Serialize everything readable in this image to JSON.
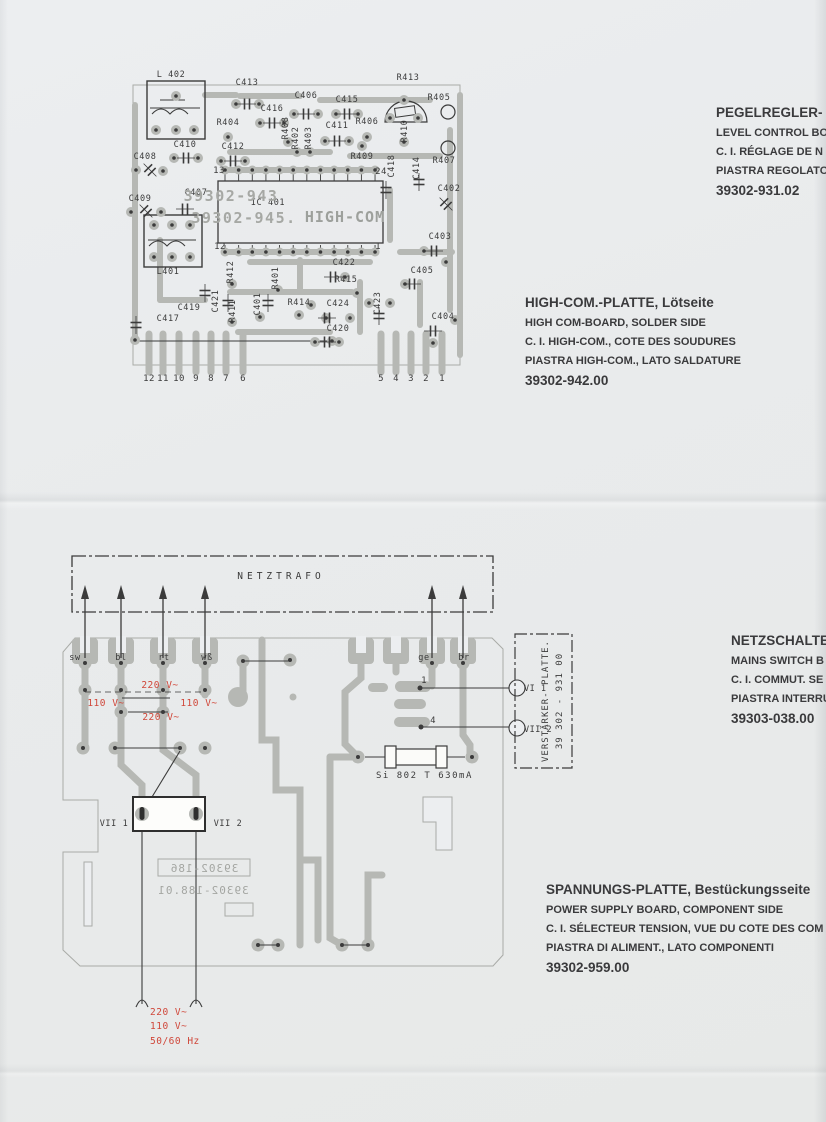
{
  "colors": {
    "trace": "#b6b8b4",
    "ink": "#3b3b3b",
    "faded_print": "#a6a8a4",
    "red": "#d0473a",
    "paper": "#e9ebec"
  },
  "captions": {
    "level_control": {
      "lines": [
        "PEGELREGLER-",
        "LEVEL CONTROL BO",
        "C. I. RÉGLAGE DE N",
        "PIASTRA REGOLATO",
        "39302-931.02"
      ]
    },
    "highcom": {
      "lines": [
        "HIGH-COM.-PLATTE, Lötseite",
        "HIGH COM-BOARD, SOLDER SIDE",
        "C. I. HIGH-COM., COTE DES SOUDURES",
        "PIASTRA HIGH-COM., LATO SALDATURE",
        "39302-942.00"
      ]
    },
    "mains_switch": {
      "lines": [
        "NETZSCHALTE",
        "MAINS SWITCH B",
        "C. I. COMMUT. SE",
        "PIASTRA INTERRU",
        "39303-038.00"
      ]
    },
    "power_supply": {
      "lines": [
        "SPANNUNGS-PLATTE, Bestückungsseite",
        "POWER SUPPLY BOARD, COMPONENT SIDE",
        "C. I. SÉLECTEUR TENSION, VUE DU COTE DES COM",
        "PIASTRA DI ALIMENT., LATO COMPONENTI",
        "39302-959.00"
      ]
    }
  },
  "top_board": {
    "labels": [
      {
        "t": "L 402",
        "x": 171,
        "y": 77
      },
      {
        "t": "C413",
        "x": 247,
        "y": 85
      },
      {
        "t": "C406",
        "x": 306,
        "y": 98
      },
      {
        "t": "C415",
        "x": 347,
        "y": 102
      },
      {
        "t": "R413",
        "x": 408,
        "y": 80
      },
      {
        "t": "R405",
        "x": 439,
        "y": 100
      },
      {
        "t": "R404",
        "x": 228,
        "y": 125
      },
      {
        "t": "C416",
        "x": 272,
        "y": 111
      },
      {
        "t": "C411",
        "x": 337,
        "y": 128
      },
      {
        "t": "R406",
        "x": 367,
        "y": 124
      },
      {
        "t": "C412",
        "x": 233,
        "y": 149
      },
      {
        "t": "C410",
        "x": 185,
        "y": 147
      },
      {
        "t": "C408",
        "x": 145,
        "y": 159
      },
      {
        "t": "C409",
        "x": 140,
        "y": 201
      },
      {
        "t": "C407",
        "x": 196,
        "y": 195
      },
      {
        "t": "R409",
        "x": 362,
        "y": 159
      },
      {
        "t": "R407",
        "x": 444,
        "y": 163
      },
      {
        "t": "C402",
        "x": 449,
        "y": 191
      },
      {
        "t": "C403",
        "x": 440,
        "y": 239
      },
      {
        "t": "C405",
        "x": 422,
        "y": 273
      },
      {
        "t": "C404",
        "x": 443,
        "y": 319
      },
      {
        "t": "C422",
        "x": 344,
        "y": 265
      },
      {
        "t": "R415",
        "x": 346,
        "y": 282
      },
      {
        "t": "R414",
        "x": 299,
        "y": 305
      },
      {
        "t": "C424",
        "x": 338,
        "y": 306
      },
      {
        "t": "C420",
        "x": 338,
        "y": 331
      },
      {
        "t": "C419",
        "x": 189,
        "y": 310
      },
      {
        "t": "C417",
        "x": 168,
        "y": 321
      },
      {
        "t": "L401",
        "x": 168,
        "y": 274
      },
      {
        "t": "IC 401",
        "x": 268,
        "y": 205
      },
      {
        "t": "R408",
        "x": 288,
        "y": 128,
        "r": -90
      },
      {
        "t": "R402",
        "x": 298,
        "y": 138,
        "r": -90
      },
      {
        "t": "R403",
        "x": 311,
        "y": 138,
        "r": -90
      },
      {
        "t": "R410",
        "x": 407,
        "y": 131,
        "r": -90
      },
      {
        "t": "C418",
        "x": 394,
        "y": 166,
        "r": -90
      },
      {
        "t": "C414",
        "x": 419,
        "y": 168,
        "r": -90
      },
      {
        "t": "R412",
        "x": 233,
        "y": 272,
        "r": -90
      },
      {
        "t": "R401",
        "x": 278,
        "y": 278,
        "r": -90
      },
      {
        "t": "C421",
        "x": 218,
        "y": 301,
        "r": -90
      },
      {
        "t": "R411",
        "x": 235,
        "y": 311,
        "r": -90
      },
      {
        "t": "C401",
        "x": 260,
        "y": 304,
        "r": -90
      },
      {
        "t": "C423",
        "x": 380,
        "y": 303,
        "r": -90
      },
      {
        "t": "39302-943",
        "x": 231,
        "y": 201,
        "c": "g1",
        "n": "board-print-39302-943"
      },
      {
        "t": "39302-945.",
        "x": 244,
        "y": 223,
        "c": "g1",
        "n": "board-print-39302-945"
      },
      {
        "t": "HIGH-COM",
        "x": 345,
        "y": 222,
        "c": "g2",
        "n": "board-print-high-com"
      },
      {
        "t": "13",
        "x": 219,
        "y": 173,
        "c": "p",
        "n": "ic-pin-13"
      },
      {
        "t": "24",
        "x": 381,
        "y": 174,
        "c": "p",
        "n": "ic-pin-24"
      },
      {
        "t": "12",
        "x": 220,
        "y": 249,
        "c": "p",
        "n": "ic-pin-12"
      },
      {
        "t": "1",
        "x": 378,
        "y": 249,
        "c": "p",
        "n": "ic-pin-1"
      },
      {
        "t": "12",
        "x": 149,
        "y": 381,
        "c": "p"
      },
      {
        "t": "11",
        "x": 163,
        "y": 381,
        "c": "p"
      },
      {
        "t": "10",
        "x": 179,
        "y": 381,
        "c": "p"
      },
      {
        "t": "9",
        "x": 196,
        "y": 381,
        "c": "p"
      },
      {
        "t": "8",
        "x": 211,
        "y": 381,
        "c": "p"
      },
      {
        "t": "7",
        "x": 226,
        "y": 381,
        "c": "p"
      },
      {
        "t": "6",
        "x": 243,
        "y": 381,
        "c": "p"
      },
      {
        "t": "5",
        "x": 381,
        "y": 381,
        "c": "p"
      },
      {
        "t": "4",
        "x": 396,
        "y": 381,
        "c": "p"
      },
      {
        "t": "3",
        "x": 411,
        "y": 381,
        "c": "p"
      },
      {
        "t": "2",
        "x": 426,
        "y": 381,
        "c": "p"
      },
      {
        "t": "1",
        "x": 442,
        "y": 381,
        "c": "p"
      }
    ]
  },
  "bottom_board": {
    "labels": [
      {
        "t": "NETZTRAFO",
        "x": 281,
        "y": 579,
        "c": "nt",
        "n": "netztrafo-label"
      },
      {
        "t": "sw",
        "x": 75,
        "y": 660
      },
      {
        "t": "bl",
        "x": 121,
        "y": 660
      },
      {
        "t": "rt",
        "x": 164,
        "y": 660
      },
      {
        "t": "wß",
        "x": 207,
        "y": 660
      },
      {
        "t": "ge",
        "x": 424,
        "y": 660
      },
      {
        "t": "br",
        "x": 464,
        "y": 660
      },
      {
        "t": "VII 1",
        "x": 114,
        "y": 826,
        "n": "connector-vii1-label"
      },
      {
        "t": "VII 2",
        "x": 228,
        "y": 826,
        "n": "connector-vii2-label"
      },
      {
        "t": "1",
        "x": 424,
        "y": 683,
        "c": "p",
        "n": "pin-1"
      },
      {
        "t": "4",
        "x": 433,
        "y": 723,
        "c": "p",
        "n": "pin-4"
      },
      {
        "t": "VI 1",
        "x": 524,
        "y": 691,
        "c": "cl",
        "n": "callout-vi1"
      },
      {
        "t": "VII 2",
        "x": 524,
        "y": 732,
        "c": "cl",
        "n": "callout-vii2"
      },
      {
        "t": "Si 802 T 630mA",
        "x": 376,
        "y": 778,
        "c": "fz",
        "n": "fuse-label"
      },
      {
        "t": "VERSTÄRKER- PLATTE.",
        "x": 548,
        "y": 701,
        "r": -90,
        "c": "vp",
        "n": "amplifier-board-label"
      },
      {
        "t": "39 302 - 931 00",
        "x": 562,
        "y": 701,
        "r": -90,
        "c": "vp",
        "n": "amplifier-board-number"
      }
    ],
    "red_labels": [
      {
        "t": "220 V~",
        "x": 160,
        "y": 688,
        "c": "red"
      },
      {
        "t": "110 V~",
        "x": 106,
        "y": 706,
        "c": "red"
      },
      {
        "t": "110 V~",
        "x": 199,
        "y": 706,
        "c": "red"
      },
      {
        "t": "220 V~",
        "x": 161,
        "y": 720,
        "c": "red"
      },
      {
        "t": "220 V~",
        "x": 150,
        "y": 1015,
        "c": "redl"
      },
      {
        "t": "110 V~",
        "x": 150,
        "y": 1029,
        "c": "redl"
      },
      {
        "t": "50/60 Hz",
        "x": 150,
        "y": 1044,
        "c": "redl"
      }
    ],
    "mirrored_labels": [
      {
        "t": "39302-186",
        "x": 204,
        "y": 872,
        "m": 1,
        "c": "mir",
        "n": "mirrored-print-39302-186"
      },
      {
        "t": "39302-188.01",
        "x": 203,
        "y": 894,
        "m": 1,
        "c": "mir",
        "n": "mirrored-print-39302-188"
      }
    ]
  }
}
